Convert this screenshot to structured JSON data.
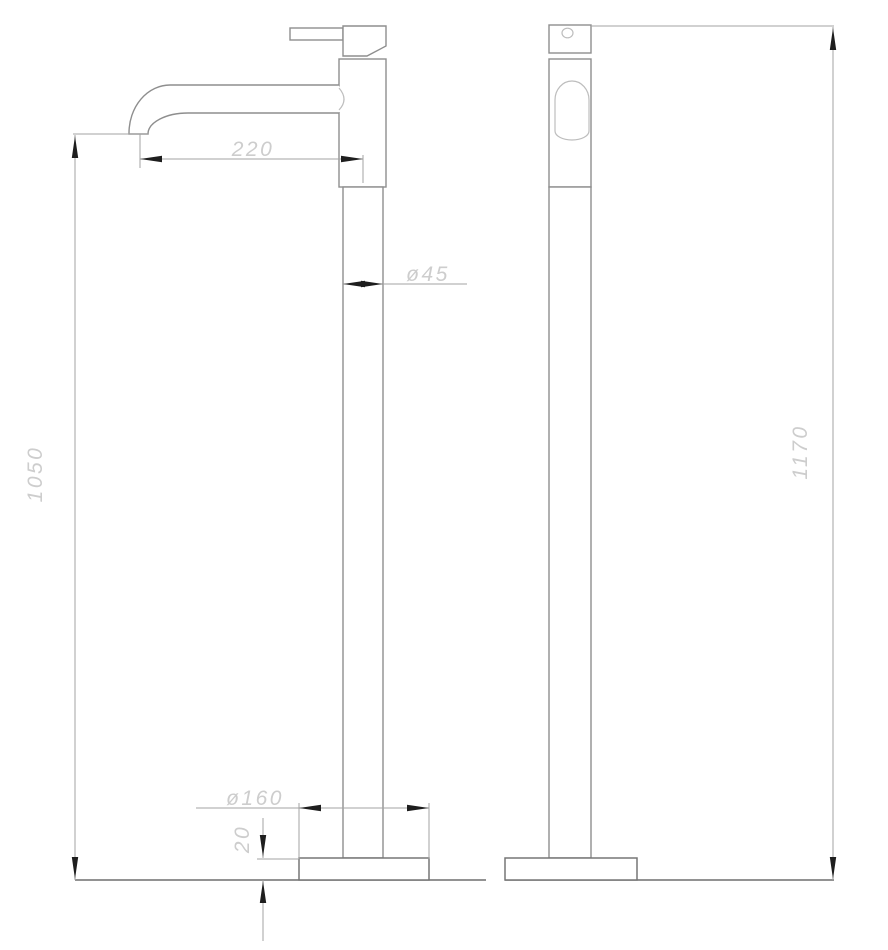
{
  "drawing": {
    "type": "technical-dimension-drawing",
    "subject": "freestanding-basin-mixer-tap",
    "views": 2
  },
  "dimensions": {
    "spout_reach": "220",
    "column_diameter": "ø45",
    "spout_height": "1050",
    "base_diameter": "ø160",
    "base_thickness": "20",
    "total_height": "1170"
  },
  "colors": {
    "background": "#ffffff",
    "outline": "#8e8e8e",
    "ground_line": "#6f6f6f",
    "dimension_line": "#a3a3a3",
    "arrowhead": "#1e1e1e",
    "dimension_text": "#cdcdcd",
    "light_detail": "#bdbdbd"
  }
}
